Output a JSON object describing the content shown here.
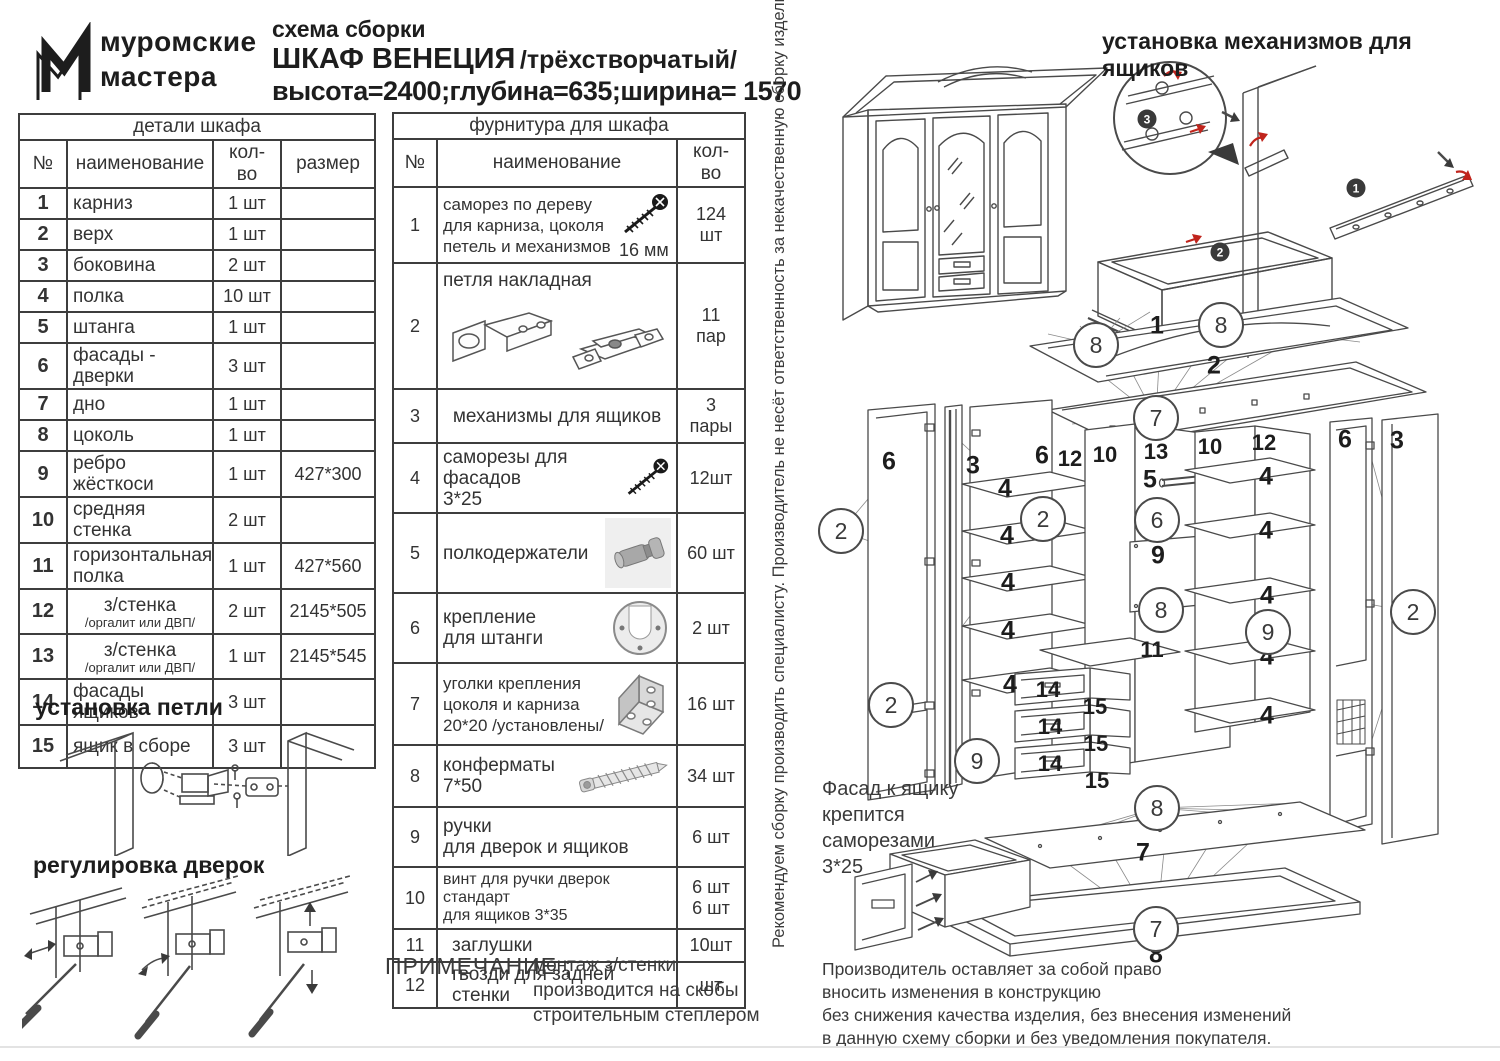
{
  "colors": {
    "ink": "#2b2b2b",
    "accent_red": "#c0241c"
  },
  "header": {
    "logo_line1": "муромские",
    "logo_line2": "мастера",
    "doc_type": "схема сборки",
    "product": "ШКАФ  ВЕНЕЦИЯ",
    "variant": "/трёхстворчатый/",
    "dimensions": "высота=2400;глубина=635;ширина= 1570"
  },
  "parts_table": {
    "title": "детали шкафа",
    "columns": [
      "№",
      "наименование",
      "кол- во",
      "размер"
    ],
    "rows": [
      {
        "n": "1",
        "name": "карниз",
        "qty": "1 шт",
        "size": ""
      },
      {
        "n": "2",
        "name": "верх",
        "qty": "1 шт",
        "size": ""
      },
      {
        "n": "3",
        "name": "боковина",
        "qty": "2 шт",
        "size": ""
      },
      {
        "n": "4",
        "name": "полка",
        "qty": "10 шт",
        "size": ""
      },
      {
        "n": "5",
        "name": "штанга",
        "qty": "1 шт",
        "size": ""
      },
      {
        "n": "6",
        "name": "фасады - дверки",
        "qty": "3 шт",
        "size": ""
      },
      {
        "n": "7",
        "name": "дно",
        "qty": "1 шт",
        "size": ""
      },
      {
        "n": "8",
        "name": "цоколь",
        "qty": "1 шт",
        "size": ""
      },
      {
        "n": "9",
        "name": "ребро жёсткоси",
        "qty": "1 шт",
        "size": "427*300"
      },
      {
        "n": "10",
        "name": "средняя стенка",
        "qty": "2 шт",
        "size": ""
      },
      {
        "n": "11",
        "name": "горизонтальная\nполка",
        "qty": "1 шт",
        "size": "427*560"
      },
      {
        "n": "12",
        "name": "з/стенка",
        "sub": "/оргалит или ДВП/",
        "qty": "2 шт",
        "size": "2145*505"
      },
      {
        "n": "13",
        "name": "з/стенка",
        "sub": "/оргалит или ДВП/",
        "qty": "1 шт",
        "size": "2145*545"
      },
      {
        "n": "14",
        "name": "фасады ящиков",
        "qty": "3 шт",
        "size": ""
      },
      {
        "n": "15",
        "name": "ящик в сборе",
        "qty": "3 шт",
        "size": ""
      }
    ]
  },
  "hardware_table": {
    "title": "фурнитура для шкафа",
    "columns": [
      "№",
      "наименование",
      "кол- во"
    ],
    "rows": [
      {
        "n": "1",
        "name": "саморез по дереву\nдля карниза, цоколя\nпетель и механизмов",
        "note": "16 мм",
        "icon": "wood-screw",
        "qty": "124 шт"
      },
      {
        "n": "2",
        "name": "петля накладная",
        "icon": "overlay-hinge",
        "qty": "11\nпар"
      },
      {
        "n": "3",
        "name": "механизмы для ящиков",
        "qty": "3\nпары"
      },
      {
        "n": "4",
        "name": "саморезы для фасадов\n3*25",
        "icon": "wood-screw",
        "qty": "12шт"
      },
      {
        "n": "5",
        "name": "полкодержатели",
        "icon": "shelf-pin",
        "qty": "60 шт"
      },
      {
        "n": "6",
        "name": "крепление\nдля штанги",
        "icon": "rod-holder",
        "qty": "2 шт"
      },
      {
        "n": "7",
        "name": "уголки крепления\nцоколя и карниза\n20*20 /установлены/",
        "icon": "angle-bracket",
        "qty": "16 шт"
      },
      {
        "n": "8",
        "name": "конферматы\n7*50",
        "icon": "confirmat",
        "qty": "34 шт"
      },
      {
        "n": "9",
        "name": "ручки\nдля дверок и ящиков",
        "qty": "6 шт"
      },
      {
        "n": "10",
        "name": "винт для ручки дверок стандарт\nдля ящиков  3*35",
        "qty": "6 шт\n6 шт"
      },
      {
        "n": "11",
        "name": "заглушки",
        "qty": "10шт"
      },
      {
        "n": "12",
        "name": "гвозди для задней стенки",
        "qty": "шт"
      }
    ]
  },
  "sections": {
    "hinge_install": "установка  петли",
    "door_adjust": "регулировка дверок",
    "drawer_mech": "установка механизмов для ящиков"
  },
  "note": {
    "label": "ПРИМЕЧАНИЕ ;",
    "text": "монтаж з/стенки\nпроизводится на скобы\nстроительным степлером"
  },
  "vertical_warning": "Рекомендуем сборку производить специалисту. Производитель не несёт ответственность за некачественную сборку изделия !!!",
  "facade_note": "Фасад к ящику\nкрепится\nсаморезами\n3*25",
  "manufacturer_note": "Производитель оставляет за собой право\nвносить изменения в конструкцию\nбез снижения качества изделия, без внесения изменений\nв данную схему сборки и без уведомления покупателя.",
  "exploded": {
    "plain_labels": [
      "1",
      "2",
      "6",
      "3",
      "6",
      "12",
      "10",
      "13",
      "5",
      "9",
      "10",
      "12",
      "6",
      "3",
      "11",
      "7",
      "8",
      "4",
      "4",
      "4",
      "4",
      "4",
      "4",
      "4",
      "4",
      "4",
      "4",
      "14",
      "14",
      "14",
      "15",
      "15",
      "15"
    ],
    "circle_labels": [
      "8",
      "8",
      "7",
      "2",
      "2",
      "6",
      "8",
      "2",
      "9",
      "9",
      "2",
      "8",
      "7"
    ]
  },
  "mech": {
    "badges": [
      "3",
      "1",
      "2"
    ]
  }
}
